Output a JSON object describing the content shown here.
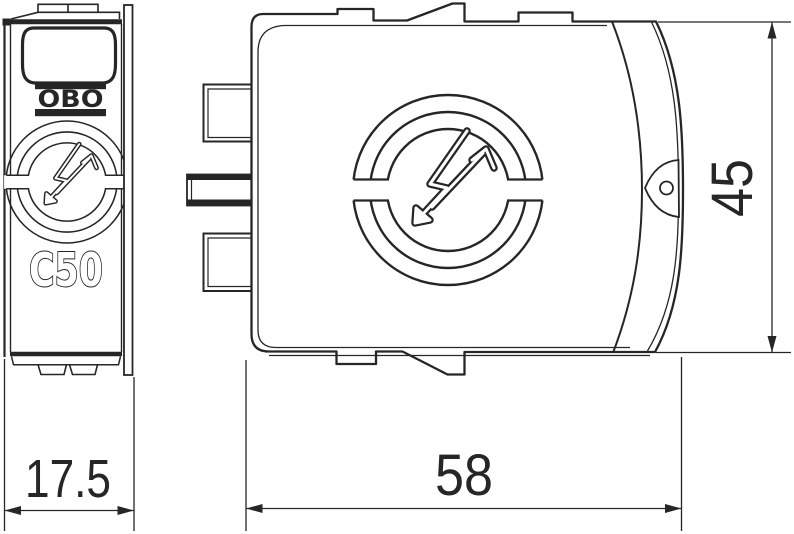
{
  "drawing": {
    "type": "technical-drawing",
    "background": "#ffffff",
    "line_color": "#262626",
    "front_view": {
      "brand_label": "OBO",
      "product_label": "C50",
      "dimension_width_mm": "17.5"
    },
    "side_view": {
      "dimension_width_mm": "58",
      "dimension_height_mm": "45"
    },
    "icons": [
      {
        "name": "surge-arrester-logo-icon",
        "shape": "three concentric broken circles with lightning arrow"
      },
      {
        "name": "obo-logo-icon",
        "shape": "OBO wordmark between two horizontal bars"
      }
    ]
  }
}
